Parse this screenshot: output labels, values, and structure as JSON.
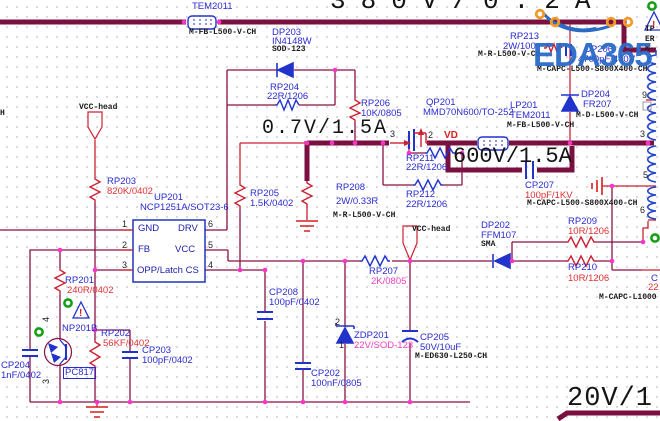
{
  "app": {
    "watermark": "EDA365"
  },
  "palette": {
    "bus_maroon": "#7a1040",
    "wire_red": "#cc2233",
    "symbol_blue": "#2233cc",
    "junction_magenta": "#ff33cc",
    "ref_blue": "#2b2bd0",
    "value_red": "#e03030",
    "value_pink": "#f040c0",
    "part_black": "#1a1a1a",
    "watermark_blue": "#2c6cc8",
    "logo_orange": "#f29b2a",
    "warning_red": "#d42020",
    "noerc_green": "#17a017"
  },
  "power_ratings": [
    {
      "n": "rating-380v",
      "t": "380V/0.2A",
      "x": 330,
      "y": -12,
      "fs": 26,
      "ls": 15
    },
    {
      "n": "rating-0v7",
      "t": "0.7V/1.5A",
      "x": 262,
      "y": 119,
      "fs": 20,
      "ls": 2
    },
    {
      "n": "rating-600v",
      "t": "600V/1.5A",
      "x": 453,
      "y": 146,
      "fs": 22,
      "ls": 0
    },
    {
      "n": "rating-20v",
      "t": "20V/1",
      "x": 567,
      "y": 386,
      "fs": 27,
      "ls": 1
    }
  ],
  "labels": [
    {
      "n": "ref-lp202",
      "t": "LP202",
      "x": 191,
      "y": -8,
      "c": "ref"
    },
    {
      "n": "ref-lp202-type",
      "t": "TEM2011",
      "x": 192,
      "y": 2,
      "c": "ref"
    },
    {
      "n": "partnum-lp202",
      "t": "M-FB-L500-V-CH",
      "x": 189,
      "y": 29,
      "c": "part"
    },
    {
      "n": "ref-dp203",
      "t": "DP203",
      "x": 272,
      "y": 28,
      "c": "ref"
    },
    {
      "n": "value-dp203",
      "t": "IN4148W",
      "x": 272,
      "y": 37,
      "c": "ref"
    },
    {
      "n": "partnum-dp203",
      "t": "SOD-123",
      "x": 272,
      "y": 46,
      "c": "part"
    },
    {
      "n": "ref-rp204",
      "t": "RP204",
      "x": 270,
      "y": 83,
      "c": "ref"
    },
    {
      "n": "value-rp204",
      "t": "22R/1206",
      "x": 267,
      "y": 92,
      "c": "valb"
    },
    {
      "n": "ref-rp206",
      "t": "RP206",
      "x": 361,
      "y": 99,
      "c": "ref"
    },
    {
      "n": "value-rp206",
      "t": "10K/0805",
      "x": 361,
      "y": 109,
      "c": "valb"
    },
    {
      "n": "ref-qp201",
      "t": "QP201",
      "x": 426,
      "y": 98,
      "c": "ref"
    },
    {
      "n": "value-qp201",
      "t": "MMD70N600/TO-252",
      "x": 423,
      "y": 108,
      "c": "ref"
    },
    {
      "n": "ref-rp213",
      "t": "RP213",
      "x": 510,
      "y": 32,
      "c": "ref"
    },
    {
      "n": "value-rp213",
      "t": "2W/100",
      "x": 503,
      "y": 42,
      "c": "valb"
    },
    {
      "n": "partnum-rp213",
      "t": "M-R-L500-V-CH",
      "x": 478,
      "y": 51,
      "c": "part"
    },
    {
      "n": "ref-cp206",
      "t": "CP206",
      "x": 584,
      "y": 45,
      "c": "ref"
    },
    {
      "n": "value-cp206",
      "t": "4700pF/400V",
      "x": 578,
      "y": 55,
      "c": "valb"
    },
    {
      "n": "partnum-cp206",
      "t": "M-CAPC-L500-S800X400-CH",
      "x": 537,
      "y": 66,
      "c": "part"
    },
    {
      "n": "ref-lp201",
      "t": "LP201",
      "x": 510,
      "y": 101,
      "c": "ref"
    },
    {
      "n": "value-lp201",
      "t": "TEM2011",
      "x": 510,
      "y": 111,
      "c": "ref"
    },
    {
      "n": "partnum-lp201",
      "t": "M-FB-L500-V-CH",
      "x": 507,
      "y": 122,
      "c": "part"
    },
    {
      "n": "ref-dp204",
      "t": "DP204",
      "x": 581,
      "y": 90,
      "c": "ref"
    },
    {
      "n": "value-dp204",
      "t": "FR207",
      "x": 583,
      "y": 100,
      "c": "ref"
    },
    {
      "n": "partnum-dp204",
      "t": "M-D-L500-V-CH",
      "x": 576,
      "y": 112,
      "c": "part"
    },
    {
      "n": "net-label-vd",
      "t": "VD",
      "x": 444,
      "y": 131,
      "c": "net"
    },
    {
      "n": "ref-rp211",
      "t": "RP211",
      "x": 406,
      "y": 154,
      "c": "ref"
    },
    {
      "n": "value-rp211",
      "t": "22R/1206",
      "x": 406,
      "y": 163,
      "c": "valb"
    },
    {
      "n": "ref-rp212",
      "t": "RP212",
      "x": 406,
      "y": 190,
      "c": "ref"
    },
    {
      "n": "value-rp212",
      "t": "22R/1206",
      "x": 406,
      "y": 200,
      "c": "valb"
    },
    {
      "n": "ref-rp205",
      "t": "RP205",
      "x": 250,
      "y": 189,
      "c": "ref"
    },
    {
      "n": "value-rp205",
      "t": "1.5K/0402",
      "x": 250,
      "y": 199,
      "c": "valb"
    },
    {
      "n": "ref-rp208",
      "t": "RP208",
      "x": 336,
      "y": 183,
      "c": "ref"
    },
    {
      "n": "value-rp208",
      "t": "2W/0.33R",
      "x": 336,
      "y": 197,
      "c": "valb"
    },
    {
      "n": "partnum-rp208",
      "t": "M-R-L500-V-CH",
      "x": 333,
      "y": 212,
      "c": "part"
    },
    {
      "n": "ref-cp207",
      "t": "CP207",
      "x": 525,
      "y": 181,
      "c": "ref"
    },
    {
      "n": "value-cp207",
      "t": "100pF/1KV",
      "x": 525,
      "y": 191,
      "c": "val"
    },
    {
      "n": "partnum-cp207",
      "t": "M-CAPC-L500-S800X400-CH",
      "x": 527,
      "y": 200,
      "c": "part"
    },
    {
      "n": "ref-rp203",
      "t": "RP203",
      "x": 107,
      "y": 177,
      "c": "ref"
    },
    {
      "n": "value-rp203",
      "t": "820K/0402",
      "x": 107,
      "y": 187,
      "c": "val"
    },
    {
      "n": "ref-up201",
      "t": "UP201",
      "x": 154,
      "y": 193,
      "c": "ref"
    },
    {
      "n": "value-up201",
      "t": "NCP1251A/SOT23-6",
      "x": 140,
      "y": 203,
      "c": "ref"
    },
    {
      "n": "port-vcc-head-left",
      "t": "VCC-head",
      "x": 79,
      "y": 104,
      "c": "part"
    },
    {
      "n": "port-vcc-head-right",
      "t": "VCC-head",
      "x": 412,
      "y": 226,
      "c": "part"
    },
    {
      "n": "ref-rp201",
      "t": "RP201",
      "x": 65,
      "y": 276,
      "c": "ref"
    },
    {
      "n": "value-rp201",
      "t": "240R/0402",
      "x": 67,
      "y": 286,
      "c": "val"
    },
    {
      "n": "ref-np201b",
      "t": "NP201B",
      "x": 62,
      "y": 324,
      "c": "ref"
    },
    {
      "n": "value-np201b",
      "t": "PC817",
      "x": 64,
      "y": 368,
      "c": "ref",
      "boxed": true
    },
    {
      "n": "ref-rp202",
      "t": "RP202",
      "x": 101,
      "y": 329,
      "c": "ref"
    },
    {
      "n": "value-rp202",
      "t": "56KF/0402",
      "x": 103,
      "y": 339,
      "c": "val"
    },
    {
      "n": "ref-cp203",
      "t": "CP203",
      "x": 142,
      "y": 346,
      "c": "ref"
    },
    {
      "n": "value-cp203",
      "t": "100pF/0402",
      "x": 142,
      "y": 356,
      "c": "valb"
    },
    {
      "n": "ref-cp204",
      "t": "CP204",
      "x": 1,
      "y": 361,
      "c": "ref"
    },
    {
      "n": "value-cp204",
      "t": "1nF/0402",
      "x": 1,
      "y": 371,
      "c": "valb"
    },
    {
      "n": "ref-cp208",
      "t": "CP208",
      "x": 269,
      "y": 288,
      "c": "ref"
    },
    {
      "n": "value-cp208",
      "t": "100pF/0402",
      "x": 269,
      "y": 298,
      "c": "valb"
    },
    {
      "n": "ref-cp202",
      "t": "CP202",
      "x": 311,
      "y": 369,
      "c": "ref"
    },
    {
      "n": "value-cp202",
      "t": "100nF/0805",
      "x": 311,
      "y": 379,
      "c": "valb"
    },
    {
      "n": "ref-zdp201",
      "t": "ZDP201",
      "x": 354,
      "y": 331,
      "c": "ref"
    },
    {
      "n": "value-zdp201",
      "t": "22V/SOD-123",
      "x": 354,
      "y": 341,
      "c": "valp"
    },
    {
      "n": "ref-cp205",
      "t": "CP205",
      "x": 420,
      "y": 333,
      "c": "ref"
    },
    {
      "n": "value-cp205",
      "t": "50V/10uF",
      "x": 420,
      "y": 343,
      "c": "valb"
    },
    {
      "n": "partnum-cp205",
      "t": "M-ED630-L250-CH",
      "x": 415,
      "y": 353,
      "c": "part"
    },
    {
      "n": "ref-rp207",
      "t": "RP207",
      "x": 369,
      "y": 267,
      "c": "ref"
    },
    {
      "n": "value-rp207",
      "t": "2K/0805",
      "x": 371,
      "y": 277,
      "c": "valp"
    },
    {
      "n": "ref-dp202",
      "t": "DP202",
      "x": 481,
      "y": 221,
      "c": "ref"
    },
    {
      "n": "value-dp202",
      "t": "FFM107",
      "x": 481,
      "y": 231,
      "c": "ref"
    },
    {
      "n": "partnum-dp202",
      "t": "SMA",
      "x": 481,
      "y": 241,
      "c": "part"
    },
    {
      "n": "ref-rp209",
      "t": "RP209",
      "x": 568,
      "y": 217,
      "c": "ref"
    },
    {
      "n": "value-rp209",
      "t": "10R/1206",
      "x": 568,
      "y": 227,
      "c": "val"
    },
    {
      "n": "ref-rp210",
      "t": "RP210",
      "x": 568,
      "y": 263,
      "c": "ref"
    },
    {
      "n": "value-rp210",
      "t": "10R/1206",
      "x": 568,
      "y": 274,
      "c": "val"
    },
    {
      "n": "partnum-cp-right",
      "t": "M-CAPC-L1000",
      "x": 599,
      "y": 294,
      "c": "part"
    },
    {
      "n": "ref-clipped-cap",
      "t": "C",
      "x": 651,
      "y": 274,
      "c": "ref"
    },
    {
      "n": "value-clipped-cap",
      "t": "22",
      "x": 648,
      "y": 283,
      "c": "val"
    },
    {
      "n": "ref-tp-clipped",
      "t": "TP",
      "x": 645,
      "y": 26,
      "c": "part"
    },
    {
      "n": "ref-er-clipped",
      "t": "ER",
      "x": 645,
      "y": 36,
      "c": "part"
    },
    {
      "n": "ref-m-clipped",
      "t": "M-",
      "x": 645,
      "y": 45,
      "c": "part"
    },
    {
      "n": "partnum-left-clipped",
      "t": "H",
      "x": 0,
      "y": 110,
      "c": "part"
    },
    {
      "n": "pin-qp201-3",
      "t": "3",
      "x": 390,
      "y": 130,
      "c": "pin"
    },
    {
      "n": "pin-qp201-2",
      "t": "2",
      "x": 428,
      "y": 131,
      "c": "pin"
    },
    {
      "n": "pin-up201-1",
      "t": "1",
      "x": 122,
      "y": 220,
      "c": "pin"
    },
    {
      "n": "pin-up201-2",
      "t": "2",
      "x": 122,
      "y": 241,
      "c": "pin"
    },
    {
      "n": "pin-up201-3",
      "t": "3",
      "x": 122,
      "y": 261,
      "c": "pin"
    },
    {
      "n": "pin-up201-6",
      "t": "6",
      "x": 208,
      "y": 220,
      "c": "pin"
    },
    {
      "n": "pin-up201-5",
      "t": "5",
      "x": 208,
      "y": 241,
      "c": "pin"
    },
    {
      "n": "pin-up201-4",
      "t": "4",
      "x": 208,
      "y": 261,
      "c": "pin"
    },
    {
      "n": "pin-xfmr-9",
      "t": "9",
      "x": 642,
      "y": 91,
      "c": "pin"
    },
    {
      "n": "pin-xfmr-3",
      "t": "3",
      "x": 640,
      "y": 130,
      "c": "pin"
    },
    {
      "n": "pin-xfmr-5",
      "t": "5",
      "x": 643,
      "y": 171,
      "c": "pin"
    },
    {
      "n": "pin-xfmr-6",
      "t": "6",
      "x": 640,
      "y": 206,
      "c": "pin"
    },
    {
      "n": "pin-zdp201-2",
      "t": "2",
      "x": 335,
      "y": 318,
      "c": "pin"
    },
    {
      "n": "pin-zdp201-1",
      "t": "1",
      "x": 339,
      "y": 341,
      "c": "pin"
    },
    {
      "n": "pin-np201b-4",
      "t": "4",
      "x": 42,
      "y": 322,
      "c": "pin",
      "rot": true
    },
    {
      "n": "pin-np201b-3",
      "t": "3",
      "x": 42,
      "y": 384,
      "c": "pin",
      "rot": true
    },
    {
      "n": "icpin-gnd",
      "t": "GND",
      "x": 138,
      "y": 224,
      "c": "ic"
    },
    {
      "n": "icpin-drv",
      "t": "DRV",
      "x": 178,
      "y": 224,
      "c": "ic"
    },
    {
      "n": "icpin-fb",
      "t": "FB",
      "x": 138,
      "y": 245,
      "c": "ic"
    },
    {
      "n": "icpin-vcc",
      "t": "VCC",
      "x": 175,
      "y": 245,
      "c": "ic"
    },
    {
      "n": "icpin-opp-latch-cs",
      "t": "OPP/Latch CS",
      "x": 137,
      "y": 266,
      "c": "ic"
    }
  ]
}
